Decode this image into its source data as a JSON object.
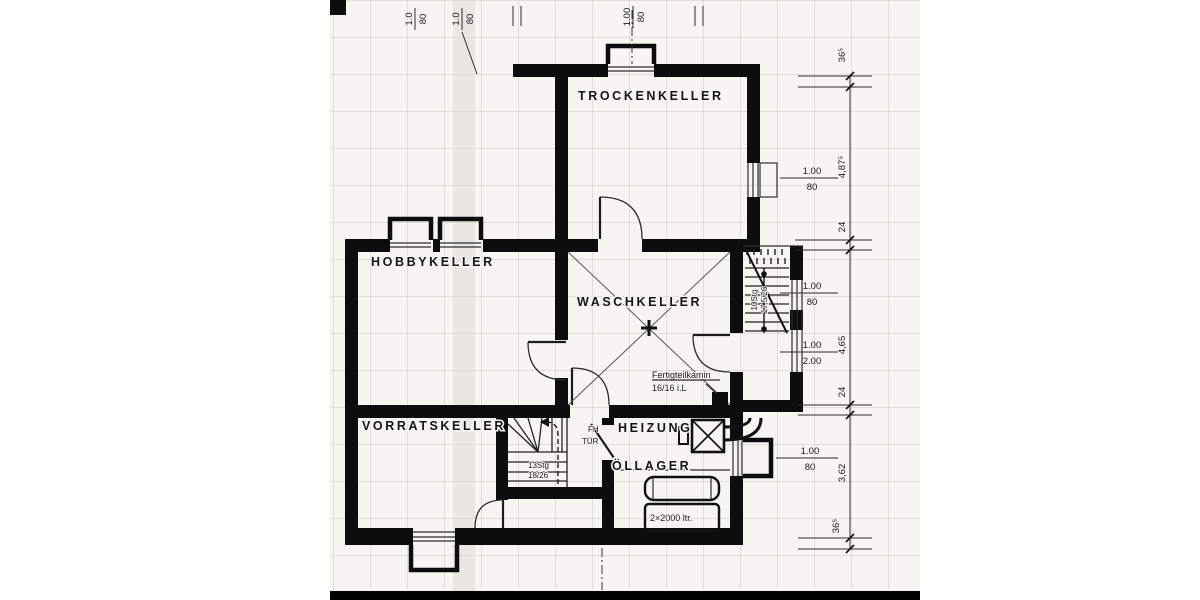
{
  "plan": {
    "rooms": {
      "trockenkeller": {
        "label": "TROCKENKELLER"
      },
      "hobbykeller": {
        "label": "HOBBYKELLER"
      },
      "waschkeller": {
        "label": "WASCHKELLER"
      },
      "vorratskeller": {
        "label": "VORRATSKELLER"
      },
      "heizung": {
        "label": "HEIZUNG"
      },
      "oellager": {
        "label": "ÖLLAGER"
      }
    },
    "annotations": {
      "chimney_line1": "Fertigteilkamin",
      "chimney_line2": "16/16 i.L",
      "tank_label": "2×2000 ltr.",
      "fire_door_line1": "FH",
      "fire_door_line2": "TÜR",
      "stair_interior_line1": "13Stg",
      "stair_interior_line2": "18/26",
      "stair_exterior_line1": "10Stg",
      "stair_exterior_line2": "17,5/26"
    },
    "dimensions": {
      "top": [
        {
          "num": "1.0",
          "den": "80"
        },
        {
          "num": "1.0",
          "den": "80"
        },
        {
          "num": "1.00",
          "den": "80"
        }
      ],
      "right_chain": [
        "36⁵",
        "4,87⁵",
        "24",
        "4,65",
        "24",
        "3,62",
        "36⁵"
      ],
      "right_openings": [
        {
          "num": "1.00",
          "den": "80"
        },
        {
          "num": "1.00",
          "den": "80"
        },
        {
          "num": "1.00",
          "den": "2.00"
        },
        {
          "num": "1.00",
          "den": "80"
        }
      ]
    },
    "colors": {
      "wall": "#0d0d0d",
      "paper": "#f6f5f1",
      "grid": "#cbc8c0",
      "ink": "#1a1a1a"
    }
  }
}
